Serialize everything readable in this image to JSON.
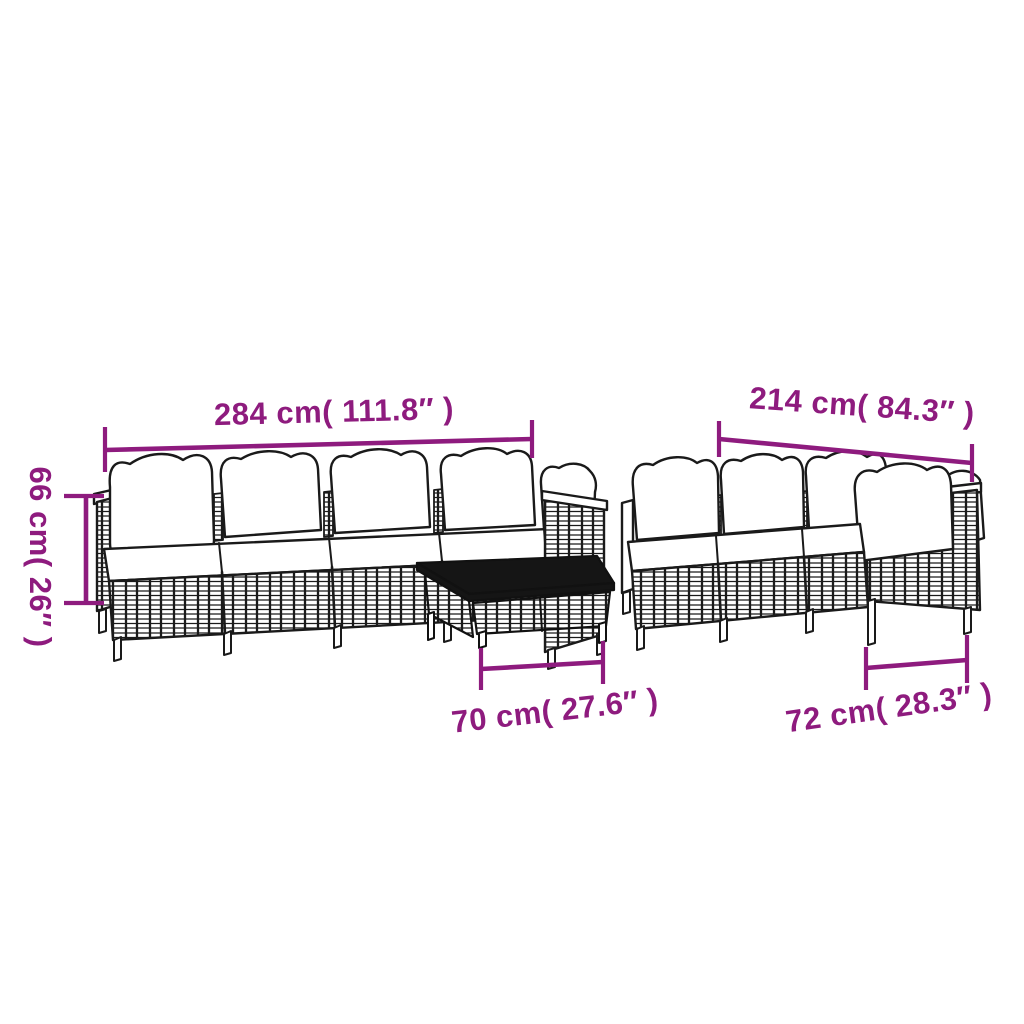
{
  "colors": {
    "accent": "#8e1b7e",
    "line": "#1a1a1a",
    "cushion": "#ffffff",
    "table_top": "#151515",
    "background": "#ffffff"
  },
  "labels": {
    "sofa_long_width": "284 cm( 111.8″ )",
    "sofa_short_width": "214 cm( 84.3″ )",
    "height": "66 cm( 26″ )",
    "table_width": "70 cm( 27.6″ )",
    "corner_module_width": "72 cm( 28.3″ )"
  }
}
